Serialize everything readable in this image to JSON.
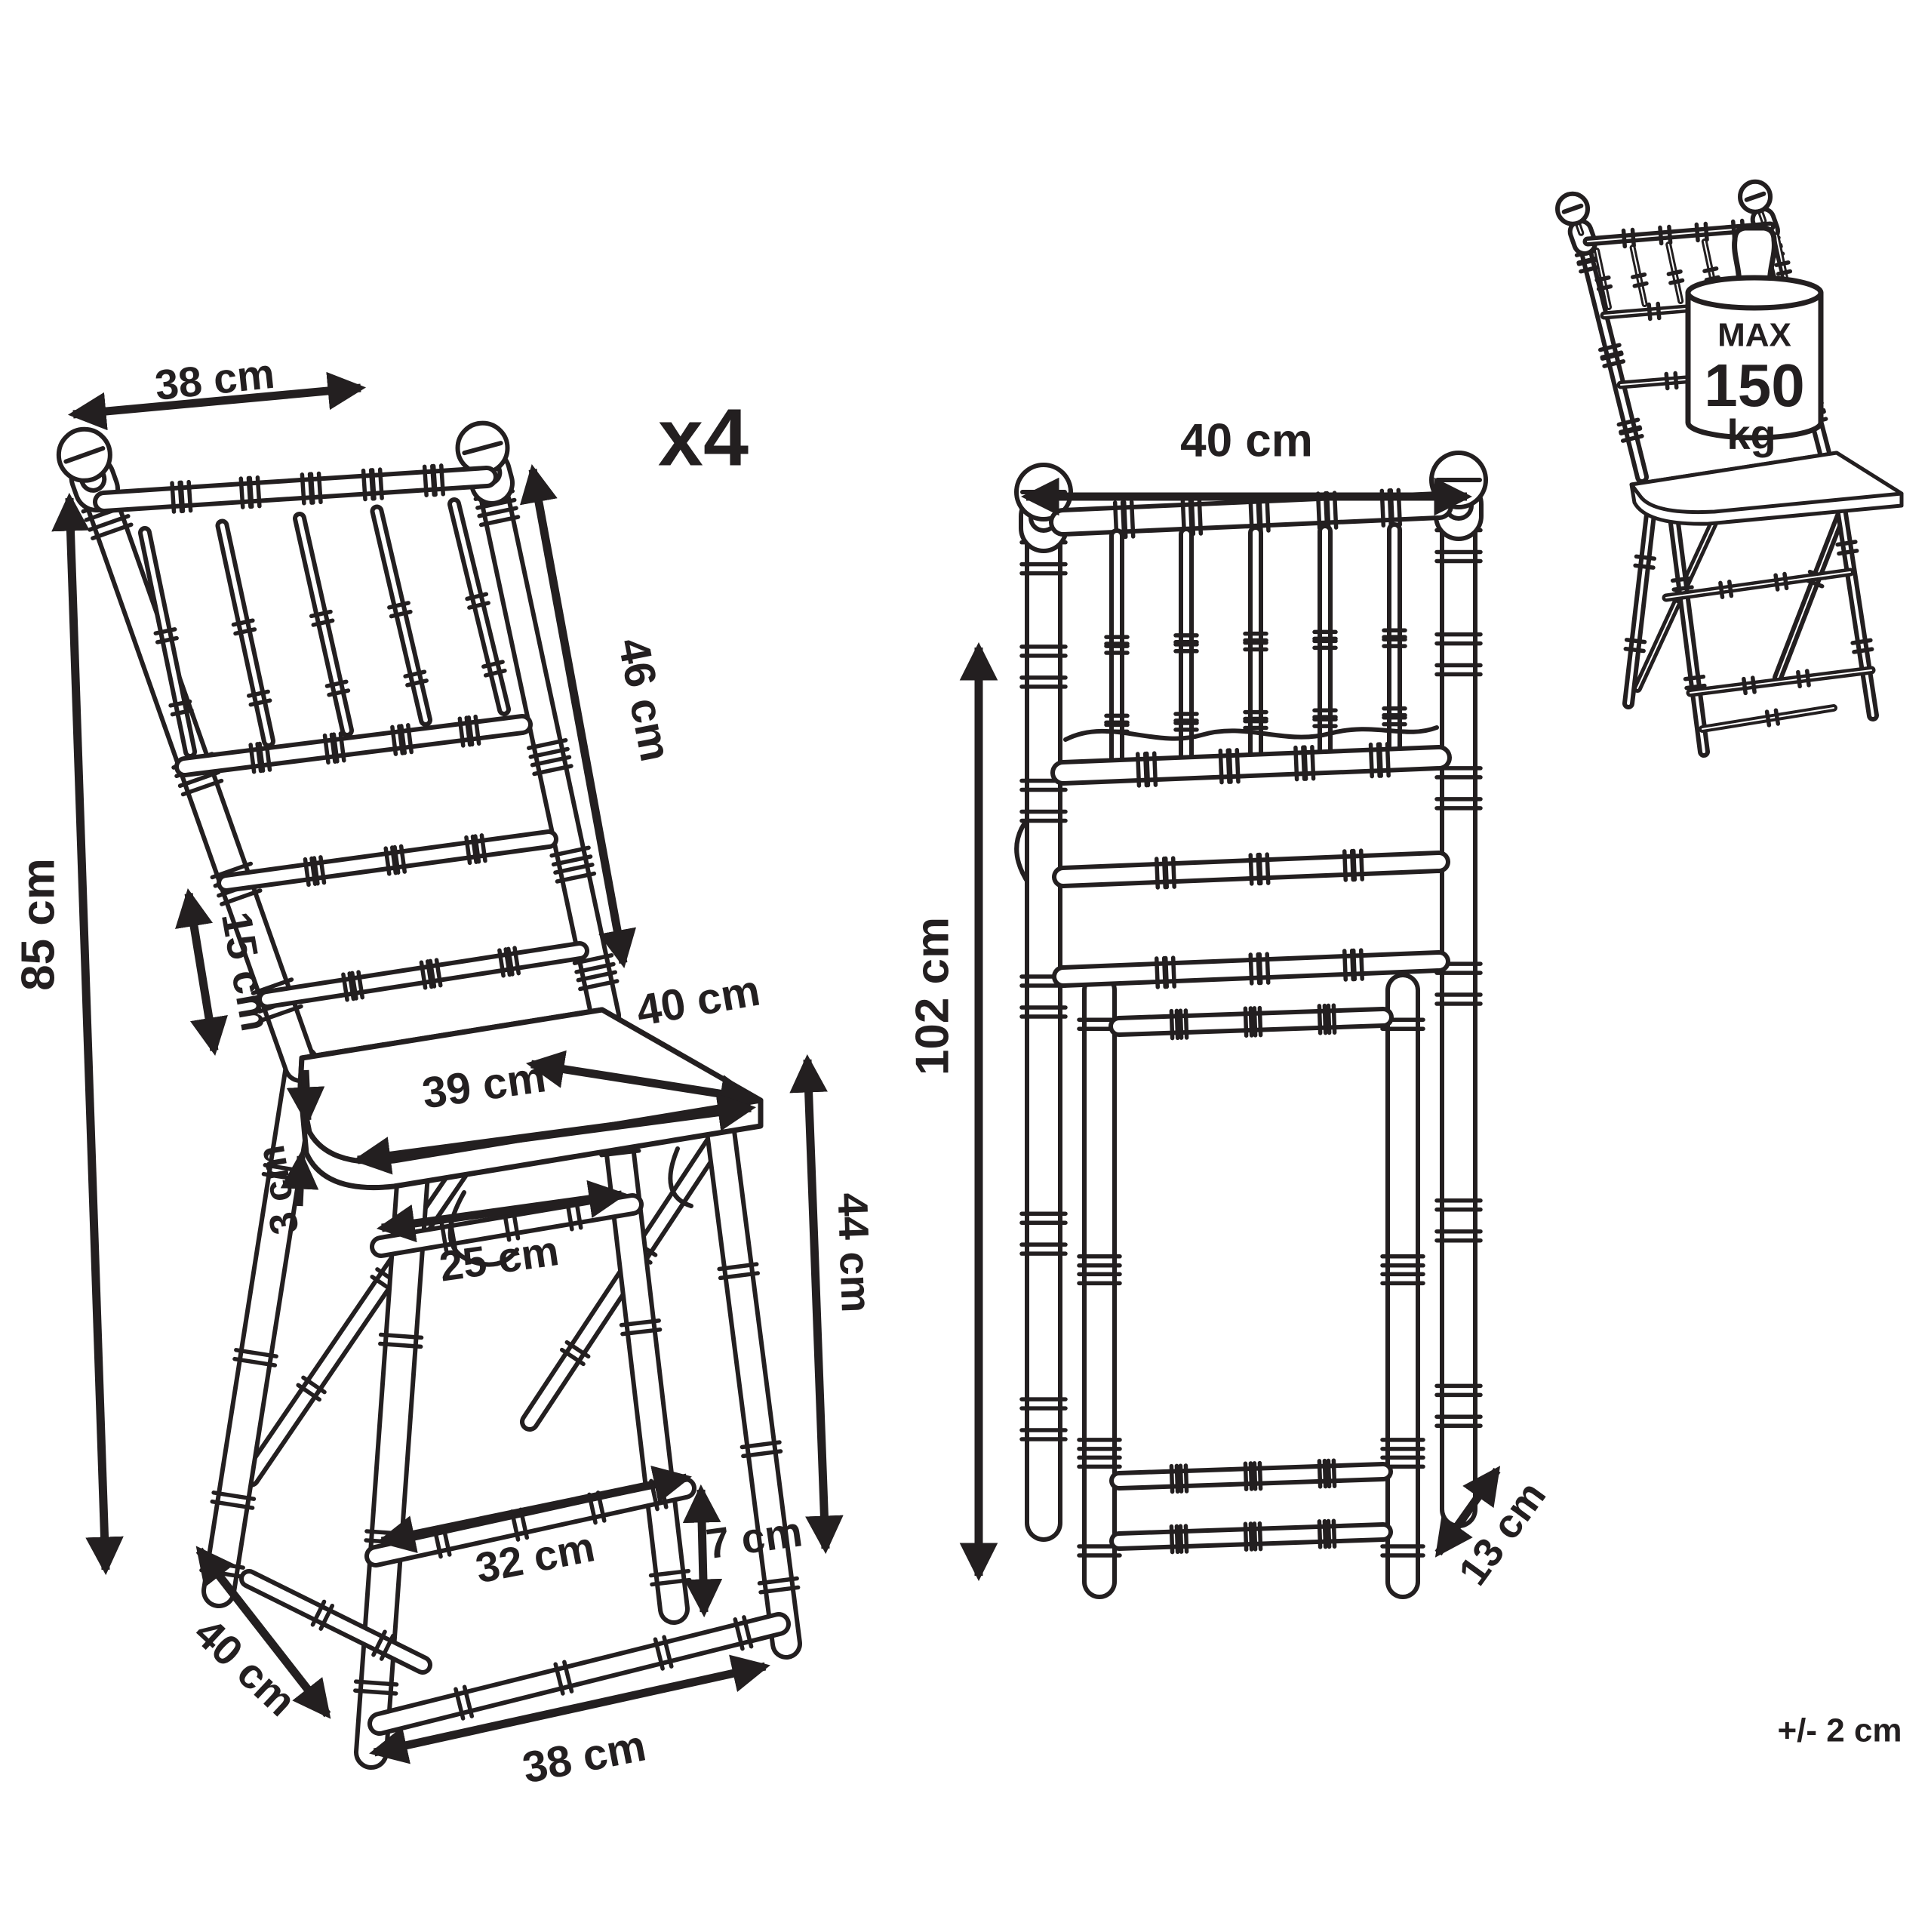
{
  "diagram": {
    "unfolded_chair": {
      "quantity_label": "x4",
      "dims": {
        "back_width": "38 cm",
        "backrest_height": "46 cm",
        "total_height": "85 cm",
        "back_gap": "15 cm",
        "seat_depth": "40 cm",
        "seat_width": "39 cm",
        "seat_thickness": "3 cm",
        "front_stretcher": "25 cm",
        "seat_height": "44 cm",
        "rear_stretcher": "32 cm",
        "foot_height": "7 cm",
        "base_depth": "40 cm",
        "base_width": "38 cm"
      }
    },
    "folded_chair": {
      "dims": {
        "width": "40 cm",
        "height": "102 cm",
        "depth": "13 cm"
      }
    },
    "weight_capacity": {
      "line1": "MAX",
      "line2": "150",
      "line3": "kg"
    },
    "tolerance": "+/- 2 cm"
  },
  "colors": {
    "line": "#231f20",
    "background": "#ffffff"
  }
}
